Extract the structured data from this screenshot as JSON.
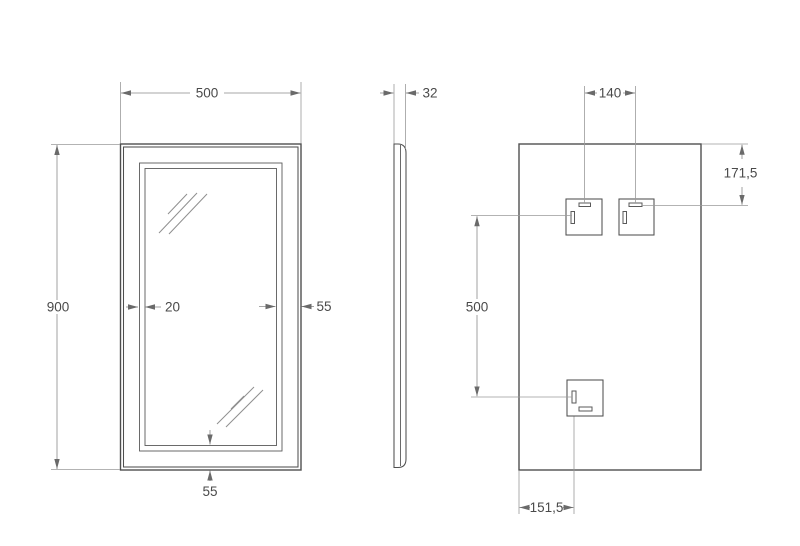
{
  "dimensions": {
    "front": {
      "width": "500",
      "height": "900",
      "inner_offset": "20",
      "frame_side": "55",
      "frame_bottom": "55"
    },
    "side": {
      "depth": "32"
    },
    "back": {
      "bracket_spacing": "140",
      "top_offset": "171,5",
      "vertical_spacing": "500",
      "left_offset": "151,5"
    }
  },
  "colors": {
    "outline": "#4f4f4f",
    "dimension_line": "#8a8a8a",
    "extension_line": "#9a9a9a",
    "label": "#4a4a4a",
    "background": "#ffffff"
  }
}
